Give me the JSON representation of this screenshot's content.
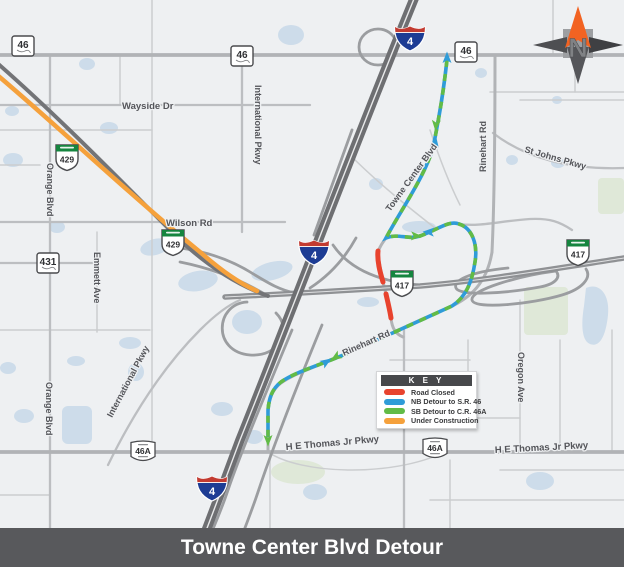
{
  "title_bar": {
    "title": "Towne Center Blvd Detour"
  },
  "compass": {
    "letter": "N"
  },
  "key": {
    "header": "K E Y",
    "items": [
      {
        "label": "Road Closed",
        "color": "#e8432e"
      },
      {
        "label": "NB Detour to S.R. 46",
        "color": "#2f9cd8"
      },
      {
        "label": "SB Detour to C.R. 46A",
        "color": "#62bb46"
      },
      {
        "label": "Under Construction",
        "color": "#f5a13c"
      }
    ]
  },
  "colors": {
    "road_closed": "#e8432e",
    "nb_detour": "#2f9cd8",
    "sb_detour": "#62bb46",
    "under_construction": "#f5a13c"
  },
  "shields": {
    "interstate": [
      {
        "num": "4"
      },
      {
        "num": "4"
      },
      {
        "num": "4"
      }
    ],
    "state": [
      {
        "num": "46"
      },
      {
        "num": "46"
      },
      {
        "num": "46"
      },
      {
        "num": "431"
      }
    ],
    "toll": [
      {
        "num": "429"
      },
      {
        "num": "429"
      },
      {
        "num": "417"
      },
      {
        "num": "417"
      }
    ],
    "county": [
      {
        "num": "46A"
      },
      {
        "num": "46A"
      }
    ]
  },
  "road_labels": {
    "wayside_dr": "Wayside Dr",
    "international_pkwy_top": "International Pkwy",
    "wilson_rd": "Wilson Rd",
    "orange_blvd_top": "Orange Blvd",
    "orange_blvd_bottom": "Orange Blvd",
    "emmett_ave": "Emmett Ave",
    "international_pkwy_bottom": "International Pkwy",
    "towne_center_blvd": "Towne Center Blvd",
    "rinehart_rd_top": "Rinehart Rd",
    "st_johns_pkwy": "St Johns Pkwy",
    "rinehart_rd_mid": "Rinehart Rd",
    "oregon_ave": "Oregon Ave",
    "he_thomas_left": "H E Thomas Jr Pkwy",
    "he_thomas_right": "H E Thomas Jr Pkwy"
  }
}
